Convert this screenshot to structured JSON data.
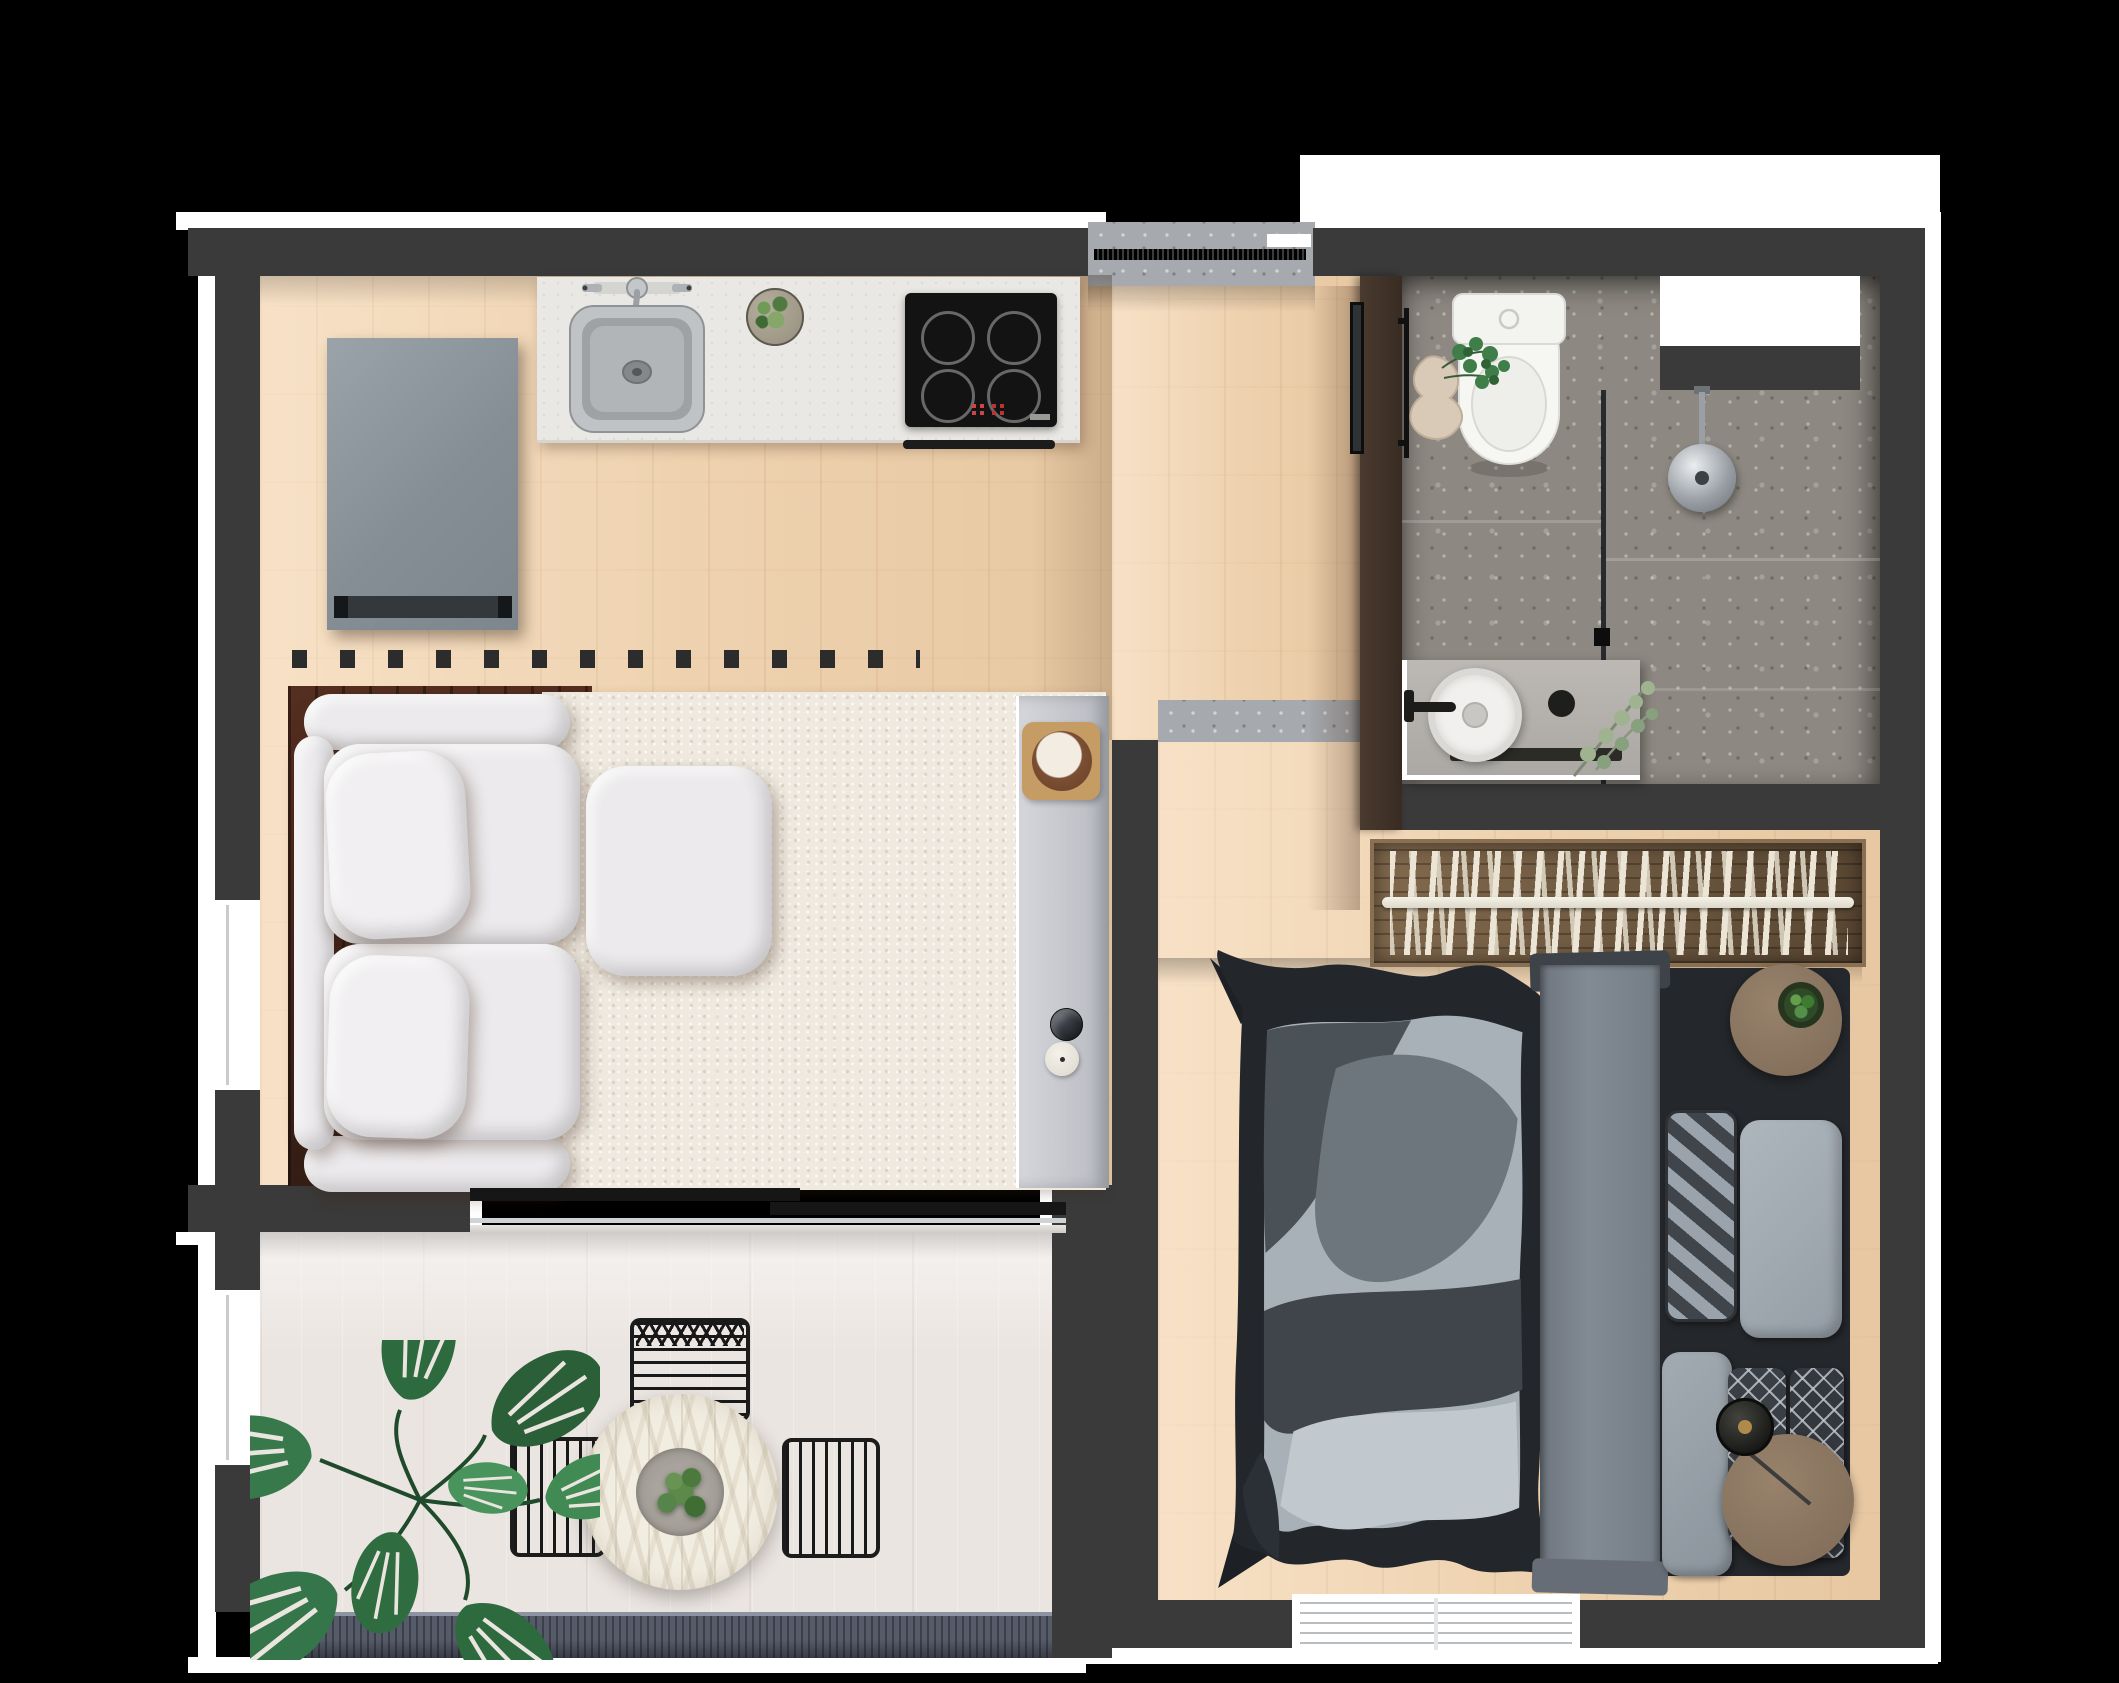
{
  "app": {
    "name": "Studio Apartment Floor Plan",
    "description": "Photorealistic top-down rendered floor plan of a small one-bedroom apartment on a black background"
  },
  "palette": {
    "background": "#000000",
    "wall": "#3a3a3a",
    "outline": "#ffffff",
    "wood_floor": "#eed3b2",
    "bathroom_terrazzo": "#8d8881",
    "entry_terrazzo": "#a6a9ad",
    "rug": "#efe9df",
    "balcony_floor": "#ebe5e1",
    "railing": "#565b6a",
    "sofa": "#eceaec",
    "duvet_light": "#a9b1b8",
    "duvet_dark": "#23262b",
    "wardrobe_wood": "#70593f",
    "hall_cabinet": "#41332a",
    "nightstand_wood": "#8d7864",
    "plant_green": "#35754a",
    "chair_black": "#1a1a1a",
    "counter": "#eae8e4",
    "cooktop": "#131313",
    "fridge": "#8a929a",
    "console": "#c7c9ce",
    "vanity": "#b5b2ae"
  },
  "rooms": {
    "kitchen_living": {
      "label": "Kitchen / Living Area",
      "floor": "light oak planks"
    },
    "entry": {
      "label": "Entry",
      "floor": "terrazzo tile"
    },
    "bathroom": {
      "label": "Bathroom",
      "floor": "terrazzo tile"
    },
    "bedroom": {
      "label": "Bedroom",
      "floor": "light oak planks"
    },
    "balcony": {
      "label": "Balcony Dining Nook",
      "floor": "pale tile"
    }
  },
  "furniture": {
    "fridge": {
      "label": "Refrigerator"
    },
    "kitchen_counter": {
      "label": "Kitchen counter"
    },
    "kitchen_sink": {
      "label": "Stainless kitchen sink with faucet"
    },
    "cooktop": {
      "label": "Induction cooktop",
      "burners": 4
    },
    "oven_handle": {
      "label": "Oven handle"
    },
    "counter_plant": {
      "label": "Potted succulent on counter"
    },
    "entry_door": {
      "label": "Entry sliding door track"
    },
    "floor_vent": {
      "label": "Floor vent strip",
      "slots": 13
    },
    "sofa": {
      "label": "Two-seat sofa",
      "seats": 2
    },
    "ottoman": {
      "label": "Square ottoman"
    },
    "rug": {
      "label": "Cream area rug"
    },
    "console": {
      "label": "Console shelf"
    },
    "tray": {
      "label": "Wooden tray with bowl"
    },
    "sphere_vase": {
      "label": "Patterned sphere vase"
    },
    "candle": {
      "label": "Round candle"
    },
    "sliding_door": {
      "label": "Sliding balcony door",
      "panels": 2
    },
    "dining_table": {
      "label": "Round chevron-top dining table"
    },
    "centerpiece": {
      "label": "Table centerpiece plant"
    },
    "dining_chairs": {
      "label": "Black wire dining chairs",
      "count": 3
    },
    "monstera": {
      "label": "Monstera floor plant",
      "leaves": 8
    },
    "railing": {
      "label": "Balcony railing"
    },
    "toilet": {
      "label": "Toilet"
    },
    "ivy_vase": {
      "label": "Sculptural vase with ivy"
    },
    "towel_rail": {
      "label": "Black towel rail"
    },
    "glass_partition": {
      "label": "Glass shower screen"
    },
    "shower_head": {
      "label": "Round rain shower head"
    },
    "shower_niche": {
      "label": "Wall niche"
    },
    "vanity": {
      "label": "Vanity counter"
    },
    "vessel_sink": {
      "label": "Round vessel sink"
    },
    "faucet": {
      "label": "Black wall-mounted faucet"
    },
    "soap_dispenser": {
      "label": "Black soap dispenser"
    },
    "eucalyptus": {
      "label": "Eucalyptus sprig"
    },
    "hall_cabinet": {
      "label": "Hall cabinet"
    },
    "mirror": {
      "label": "Leaning mirror"
    },
    "wardrobe": {
      "label": "Open wardrobe with rail",
      "hangers": 23
    },
    "threshold": {
      "label": "Terrazzo threshold"
    },
    "bed": {
      "label": "Double bed",
      "pillows": 5
    },
    "duvet": {
      "label": "Abstract patterned duvet"
    },
    "runner": {
      "label": "Gray bed runner"
    },
    "nightstand_top": {
      "label": "Round nightstand with potted plant"
    },
    "nightstand_bottom": {
      "label": "Round nightstand with fan"
    },
    "bedroom_window": {
      "label": "Bedroom window"
    },
    "west_windows": {
      "label": "West facade windows",
      "count": 2
    }
  }
}
